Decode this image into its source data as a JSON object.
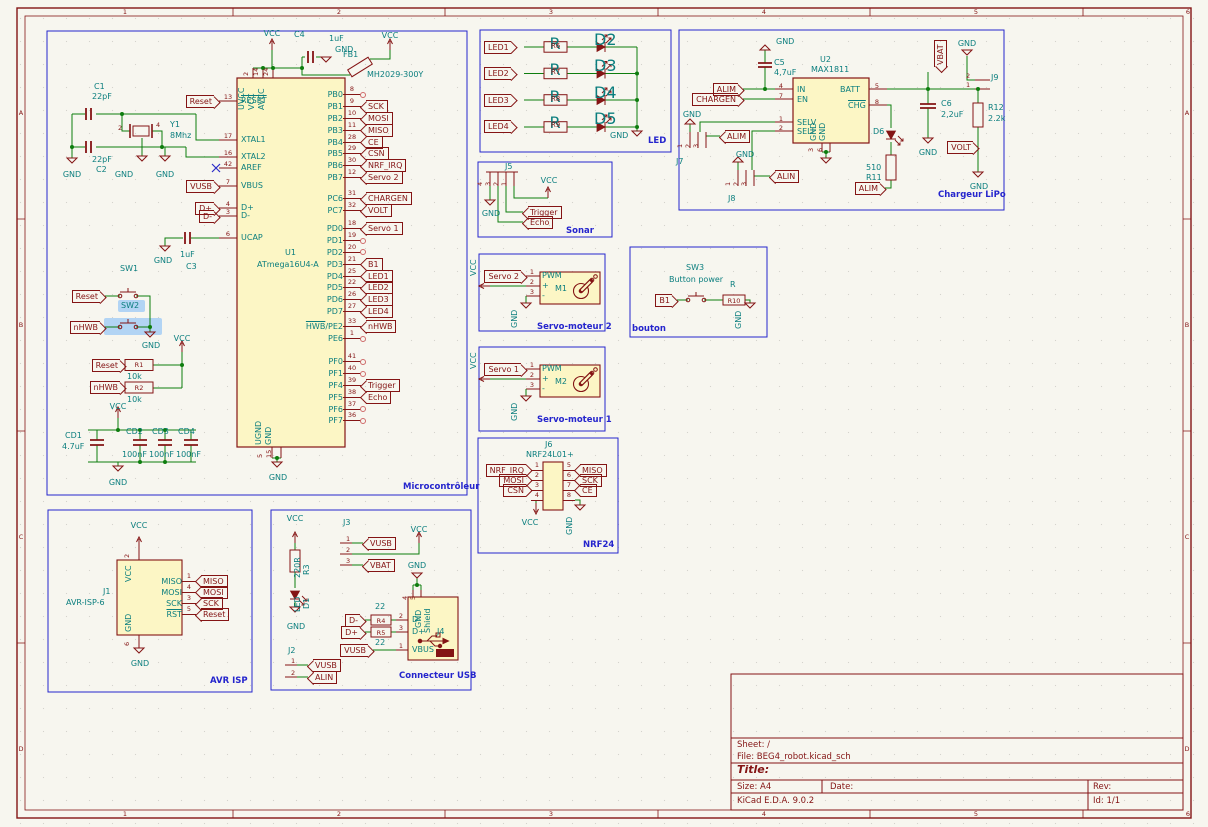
{
  "frame": {
    "cols": [
      "1",
      "2",
      "3",
      "4",
      "5",
      "6"
    ],
    "rows": [
      "A",
      "B",
      "C",
      "D"
    ]
  },
  "tb": {
    "sheet": "Sheet: /",
    "file": "File: BEG4_robot.kicad_sch",
    "title": "Title:",
    "size": "Size: A4",
    "date": "Date:",
    "rev": "Rev:",
    "app": "KiCad E.D.A. 9.0.2",
    "id": "Id: 1/1"
  },
  "mcu": {
    "title": "Microcontrôleur",
    "ref": "U1",
    "value": "ATmega16U4-A",
    "vcc_top": "VCC",
    "vcc_top2": "VCC",
    "c4_ref": "C4",
    "c4_val": "1uF",
    "gnd_c4": "GND",
    "fb_ref": "FB1",
    "fb_val": "MH2029-300Y",
    "top_nums": [
      "2",
      "14",
      "24"
    ],
    "top_names": [
      "UVCC",
      "VCC",
      "AVCC"
    ],
    "bot_nums": [
      "5",
      "15"
    ],
    "bot_names": [
      "UGND",
      "GND"
    ],
    "gnd_bot": "GND",
    "c1_ref": "C1",
    "c1_val": "22pF",
    "c2_val": "22pF",
    "c2_ref": "C2",
    "y1_ref": "Y1",
    "y1_val": "8Mhz",
    "y1_p2": "2",
    "y1_p4": "4",
    "gnd1": "GND",
    "gnd2": "GND",
    "gnd3": "GND",
    "reset_lbl": "Reset",
    "vusb_lbl": "VUSB",
    "dp_lbl": "D+",
    "dm_lbl": "D-",
    "lp": [
      {
        "num": "13",
        "name": "RESET"
      },
      {
        "num": "17",
        "name": "XTAL1"
      },
      {
        "num": "16",
        "name": "XTAL2"
      },
      {
        "num": "42",
        "name": "AREF"
      },
      {
        "num": "7",
        "name": "VBUS"
      },
      {
        "num": "4",
        "name": "D+"
      },
      {
        "num": "3",
        "name": "D-"
      },
      {
        "num": "6",
        "name": "UCAP"
      }
    ],
    "c3_val": "1uF",
    "c3_ref": "C3",
    "gnd_c3": "GND",
    "sw1_ref": "SW1",
    "sw1_lbl": "Reset",
    "sw2_ref": "SW2",
    "sw2_lbl": "nHWB",
    "gnd_sw": "GND",
    "vcc_sw": "VCC",
    "r1_ref": "R1",
    "r1_val": "10k",
    "r1_lbl": "Reset",
    "r2_ref": "R2",
    "r2_val": "10k",
    "r2_lbl": "nHWB",
    "vcc_dec": "VCC",
    "gnd_dec": "GND",
    "cd1_ref": "CD1",
    "cd1_val": "4.7uF",
    "cd_refs": [
      "CD2",
      "CD3",
      "CD4"
    ],
    "cd_vals": [
      "100nF",
      "100nF",
      "100nF"
    ],
    "rg": [
      {
        "pins": [
          {
            "name": "PB0",
            "num": "8"
          },
          {
            "name": "PB1",
            "num": "9",
            "lbl": "SCK"
          },
          {
            "name": "PB2",
            "num": "10",
            "lbl": "MOSI"
          },
          {
            "name": "PB3",
            "num": "11",
            "lbl": "MISO"
          },
          {
            "name": "PB4",
            "num": "28",
            "lbl": "CE"
          },
          {
            "name": "PB5",
            "num": "29",
            "lbl": "CSN"
          },
          {
            "name": "PB6",
            "num": "30",
            "lbl": "NRF_IRQ"
          },
          {
            "name": "PB7",
            "num": "12",
            "lbl": "Servo 2"
          }
        ]
      },
      {
        "pins": [
          {
            "name": "PC6",
            "num": "31",
            "lbl": "CHARGEN"
          },
          {
            "name": "PC7",
            "num": "32",
            "lbl": "VOLT"
          }
        ]
      },
      {
        "pins": [
          {
            "name": "PD0",
            "num": "18",
            "lbl": "Servo 1"
          },
          {
            "name": "PD1",
            "num": "19"
          },
          {
            "name": "PD2",
            "num": "20"
          },
          {
            "name": "PD3",
            "num": "21",
            "lbl": "B1"
          },
          {
            "name": "PD4",
            "num": "25",
            "lbl": "LED1"
          },
          {
            "name": "PD5",
            "num": "22",
            "lbl": "LED2"
          },
          {
            "name": "PD6",
            "num": "26",
            "lbl": "LED3"
          },
          {
            "name": "PD7",
            "num": "27",
            "lbl": "LED4"
          }
        ]
      },
      {
        "pins": [
          {
            "nameOv": "HWB",
            "name": "/PE2",
            "num": "33",
            "lbl": "nHWB"
          },
          {
            "name": "PE6",
            "num": "1"
          }
        ]
      },
      {
        "pins": [
          {
            "name": "PF0",
            "num": "41"
          },
          {
            "name": "PF1",
            "num": "40"
          },
          {
            "name": "PF4",
            "num": "39",
            "lbl": "Trigger"
          },
          {
            "name": "PF5",
            "num": "38",
            "lbl": "Echo"
          },
          {
            "name": "PF6",
            "num": "37"
          },
          {
            "name": "PF7",
            "num": "36"
          }
        ]
      }
    ]
  },
  "led": {
    "title": "LED",
    "gnd": "GND",
    "rows": [
      {
        "lbl": "LED1",
        "rval": "R",
        "rref": "R6",
        "dref": "D2"
      },
      {
        "lbl": "LED2",
        "rval": "R",
        "rref": "R7",
        "dref": "D3"
      },
      {
        "lbl": "LED3",
        "rval": "R",
        "rref": "R8",
        "dref": "D4"
      },
      {
        "lbl": "LED4",
        "rval": "R",
        "rref": "R9",
        "dref": "D5"
      }
    ]
  },
  "chg": {
    "title": "Chargeur LiPo",
    "u_ref": "U2",
    "u_val": "MAX1811",
    "p_in": "IN",
    "p_en": "EN",
    "p_batt": "BATT",
    "p_chg": "CHG",
    "p_selv": "SELV",
    "p_seli": "SELI",
    "p_gnd1": "GND",
    "p_gnd2": "GND",
    "n4": "4",
    "n7": "7",
    "n5": "5",
    "n8": "8",
    "n1": "1",
    "n2": "2",
    "n3": "3",
    "n6": "6",
    "c5_ref": "C5",
    "c5_val": "4,7uF",
    "gnd_c5": "GND",
    "alim1": "ALIM",
    "chargen": "CHARGEN",
    "gnd_j7": "GND",
    "j7": "J7",
    "j7_nums": [
      "1",
      "2",
      "3"
    ],
    "alim2": "ALIM",
    "gnd_j8": "GND",
    "j8": "J8",
    "j8_nums": [
      "1",
      "2",
      "3"
    ],
    "alin": "ALIN",
    "d6_ref": "D6",
    "r11_val": "510",
    "r11_ref": "R11",
    "alim3": "ALIM",
    "vbat": "VBAT",
    "c6_ref": "C6",
    "c6_val": "2,2uF",
    "gnd_c6": "GND",
    "r12_ref": "R12",
    "r12_val": "2.2k",
    "volt": "VOLT",
    "gnd_r12": "GND",
    "gnd_j9": "GND",
    "j9": "J9",
    "j9_n1": "1",
    "j9_n2": "2"
  },
  "sonar": {
    "title": "Sonar",
    "j5": "J5",
    "nums": [
      "4",
      "3",
      "2",
      "1"
    ],
    "vcc": "VCC",
    "gnd": "GND",
    "trigger": "Trigger",
    "echo": "Echo"
  },
  "servo2": {
    "title": "Servo-moteur 2",
    "vcc": "VCC",
    "lbl": "Servo 2",
    "n1": "1",
    "n2": "2",
    "n3": "3",
    "pwm": "PWM",
    "plus": "+",
    "minus": "-",
    "m": "M1",
    "gnd": "GND"
  },
  "servo1": {
    "title": "Servo-moteur 1",
    "vcc": "VCC",
    "lbl": "Servo 1",
    "n1": "1",
    "n2": "2",
    "n3": "3",
    "pwm": "PWM",
    "plus": "+",
    "minus": "-",
    "m": "M2",
    "gnd": "GND"
  },
  "btn": {
    "title": "bouton",
    "sw": "SW3",
    "name": "Button power",
    "b1": "B1",
    "rval": "R",
    "rref": "R10",
    "gnd": "GND"
  },
  "nrf": {
    "title": "NRF24",
    "j6": "J6",
    "val": "NRF24L01+",
    "vcc": "VCC",
    "gnd": "GND",
    "left": [
      {
        "lbl": "NRF_IRQ",
        "n": "1"
      },
      {
        "lbl": "MOSI",
        "n": "2"
      },
      {
        "lbl": "CSN",
        "n": "3"
      },
      {
        "n": "4"
      }
    ],
    "right": [
      {
        "n": "5",
        "lbl": "MISO"
      },
      {
        "n": "6",
        "lbl": "SCK"
      },
      {
        "n": "7",
        "lbl": "CE"
      },
      {
        "n": "8"
      }
    ]
  },
  "isp": {
    "title": "AVR ISP",
    "ref": "J1",
    "val": "AVR-ISP-6",
    "vcc": "VCC",
    "gnd": "GND",
    "pvcc": "VCC",
    "pgnd": "GND",
    "n2": "2",
    "n6": "6",
    "rows": [
      {
        "name": "MISO",
        "n": "1",
        "lbl": "MISO"
      },
      {
        "name": "MOSI",
        "n": "4",
        "lbl": "MOSI"
      },
      {
        "name": "SCK",
        "n": "3",
        "lbl": "SCK"
      },
      {
        "nameOv": "RST",
        "n": "5",
        "lbl": "Reset"
      }
    ]
  },
  "usb": {
    "title": "Connecteur USB",
    "vcc1": "VCC",
    "r3_val": "220R",
    "r3_ref": "R3",
    "d1_val": "LED",
    "d1_ref": "D1",
    "gnd1": "GND",
    "j3": "J3",
    "j3_nums": [
      "1",
      "2",
      "3"
    ],
    "vusb_j3": "VUSB",
    "vbat": "VBAT",
    "vcc2": "VCC",
    "j2": "J2",
    "j2_nums": [
      "1",
      "2"
    ],
    "vusb_j2": "VUSB",
    "alin": "ALIN",
    "gnd2": "GND",
    "j4": "J4",
    "n4": "4",
    "n5": "5",
    "pgnd": "GND",
    "pshield": "Shield",
    "pdm": "D-",
    "pdp": "D+",
    "pvbus": "VBUS",
    "n2": "2",
    "n3": "3",
    "n1": "1",
    "r4_val": "22",
    "r4_ref": "R4",
    "r5_ref": "R5",
    "r5_val": "22",
    "dm": "D-",
    "dp": "D+",
    "vusb_j4": "VUSB"
  }
}
